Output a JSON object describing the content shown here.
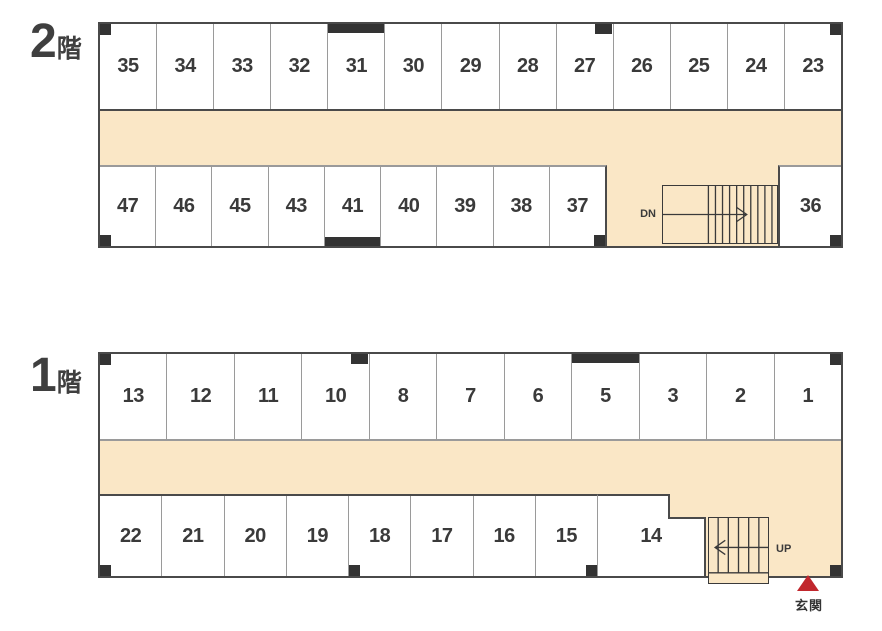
{
  "colors": {
    "corridor_fill": "#FAE7C6",
    "wall_dark": "#4A4A4A",
    "wall_gray": "#9A9A9A",
    "stair_line": "#3A3A3A",
    "unit_text": "#3A3A3A",
    "pillar": "#333333",
    "entrance_red": "#C1272D"
  },
  "floors": [
    {
      "id": "2f",
      "label_number": "2",
      "label_suffix": "階",
      "top_units": [
        {
          "label": "35",
          "marks": [
            "pillar-tl"
          ]
        },
        {
          "label": "34"
        },
        {
          "label": "33"
        },
        {
          "label": "32"
        },
        {
          "label": "31",
          "marks": [
            "bar-top"
          ]
        },
        {
          "label": "30"
        },
        {
          "label": "29"
        },
        {
          "label": "28"
        },
        {
          "label": "27",
          "marks": [
            "marker-tr"
          ]
        },
        {
          "label": "26"
        },
        {
          "label": "25"
        },
        {
          "label": "24"
        },
        {
          "label": "23",
          "marks": [
            "pillar-tr"
          ]
        }
      ],
      "bottom_units": [
        {
          "label": "47",
          "marks": [
            "pillar-bl"
          ]
        },
        {
          "label": "46"
        },
        {
          "label": "45"
        },
        {
          "label": "43"
        },
        {
          "label": "41",
          "marks": [
            "bar-bottom"
          ]
        },
        {
          "label": "40"
        },
        {
          "label": "39"
        },
        {
          "label": "38"
        },
        {
          "label": "37",
          "marks": [
            "pillar-br"
          ]
        }
      ],
      "corner_unit": {
        "label": "36",
        "marks": [
          "pillar-br"
        ]
      },
      "stairs": {
        "label": "DN",
        "direction": "right"
      }
    },
    {
      "id": "1f",
      "label_number": "1",
      "label_suffix": "階",
      "top_units": [
        {
          "label": "13",
          "marks": [
            "pillar-tl"
          ]
        },
        {
          "label": "12"
        },
        {
          "label": "11"
        },
        {
          "label": "10",
          "marks": [
            "marker-tr"
          ]
        },
        {
          "label": "8"
        },
        {
          "label": "7"
        },
        {
          "label": "6"
        },
        {
          "label": "5",
          "marks": [
            "bar-top"
          ]
        },
        {
          "label": "3"
        },
        {
          "label": "2"
        },
        {
          "label": "1",
          "marks": [
            "pillar-tr"
          ]
        }
      ],
      "bottom_units": [
        {
          "label": "22",
          "marks": [
            "pillar-bl"
          ]
        },
        {
          "label": "21"
        },
        {
          "label": "20"
        },
        {
          "label": "19"
        },
        {
          "label": "18",
          "marks": [
            "pillar-bl"
          ]
        },
        {
          "label": "17"
        },
        {
          "label": "16"
        },
        {
          "label": "15",
          "marks": [
            "pillar-br"
          ]
        }
      ],
      "wide_unit": {
        "label": "14"
      },
      "stairs": {
        "label": "UP",
        "direction": "left"
      },
      "entrance": {
        "label": "玄関"
      }
    }
  ]
}
